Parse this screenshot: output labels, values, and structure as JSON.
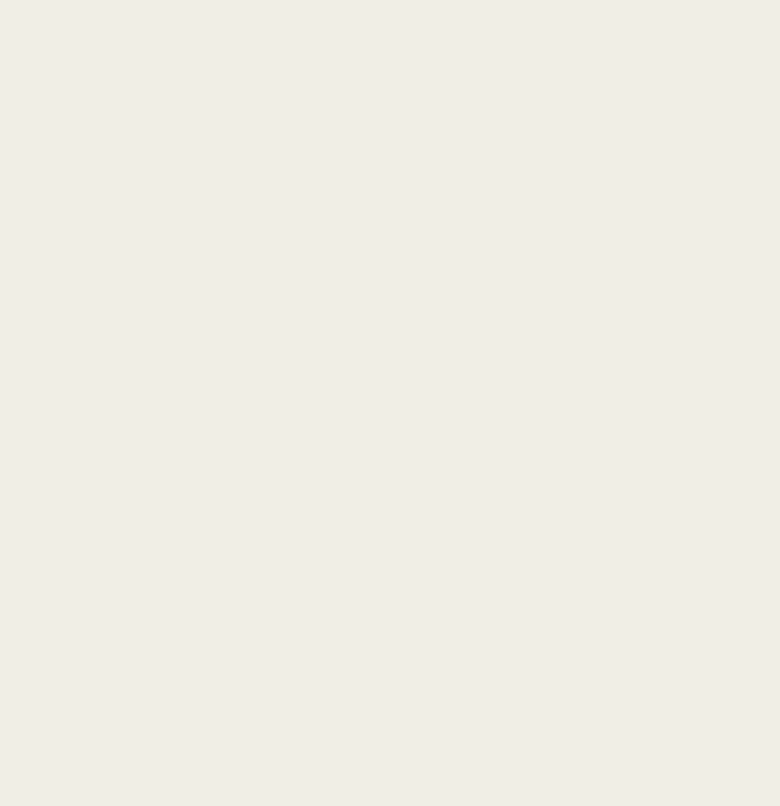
{
  "map": {
    "kind": "urban-master-plan",
    "colors": {
      "background": "#f0eee5",
      "road": "#cbcac3",
      "road_edge": "#b9b8b1",
      "water": "#a9cfe2",
      "site_green": "#a8bd87",
      "tree_dark": "#4e7c3e",
      "tree_dark_edge": "#34592c",
      "tree_light_1": "#7ba15c",
      "tree_light_2": "#6b9351",
      "tree_light_3": "#86ab66",
      "building": "#fdfdf8",
      "building_edge": "#5b584e",
      "building_shadow": "#8a8878",
      "building_tan": "#b98a55",
      "red_chip": "#c03a2b",
      "boundary_red": "#d23a2e",
      "track_ring": "#b0713c",
      "field_green": "#7fa45c",
      "ink": "#44423a"
    },
    "north_arrow": {
      "present": true
    },
    "scale_bar": {
      "ticks": [
        {
          "label": "0",
          "x": 485
        },
        {
          "label": "50",
          "x": 498
        },
        {
          "label": "100",
          "x": 512
        },
        {
          "label": "250",
          "x": 563
        },
        {
          "label": "500",
          "x": 641
        }
      ]
    },
    "labels": [
      {
        "text": "通福路",
        "x": 336,
        "y": 12,
        "size": 6,
        "kind": "road"
      },
      {
        "text": "科研路",
        "x": 163,
        "y": 330,
        "size": 5.5,
        "kind": "road"
      },
      {
        "text": "华丰大路",
        "x": 380,
        "y": 427,
        "size": 5.5,
        "kind": "road"
      },
      {
        "text": "恒丰路",
        "x": 577,
        "y": 429,
        "size": 5.5,
        "kind": "road"
      },
      {
        "text": "石大路",
        "x": 391,
        "y": 672,
        "size": 6,
        "rot": -9,
        "kind": "road"
      },
      {
        "text": "石大路",
        "x": 567,
        "y": 656,
        "size": 6,
        "rot": -6,
        "kind": "road"
      },
      {
        "text": "石桥路",
        "x": 147,
        "y": 628,
        "size": 6,
        "vertical": true,
        "kind": "road"
      },
      {
        "text": "科技路",
        "x": 420,
        "y": 352,
        "size": 5.5,
        "vertical": true,
        "kind": "road"
      },
      {
        "text": "绿化",
        "x": 88,
        "y": 795,
        "size": 6,
        "kind": "road",
        "color": "#6a6a60"
      },
      {
        "text": "石桥村营地",
        "x": 620,
        "y": 295,
        "size": 5,
        "kind": "site"
      },
      {
        "text": "大学生人才公寓",
        "x": 437,
        "y": 315,
        "size": 4.5,
        "kind": "site"
      },
      {
        "text": "急诊急救医务公寓",
        "x": 302,
        "y": 287,
        "size": 4.5,
        "kind": "site"
      },
      {
        "text": "福祉养老社区",
        "x": 172,
        "y": 268,
        "size": 4.5,
        "kind": "site"
      },
      {
        "text": "怡和大厦",
        "x": 451,
        "y": 400,
        "size": 4.5,
        "kind": "site"
      },
      {
        "text": "公交首末站与停保场",
        "x": 627,
        "y": 567,
        "size": 4.5,
        "kind": "site",
        "color": "#274a27"
      },
      {
        "text": "置地·商业",
        "x": 369,
        "y": 300,
        "size": 4.5,
        "kind": "site"
      }
    ]
  }
}
